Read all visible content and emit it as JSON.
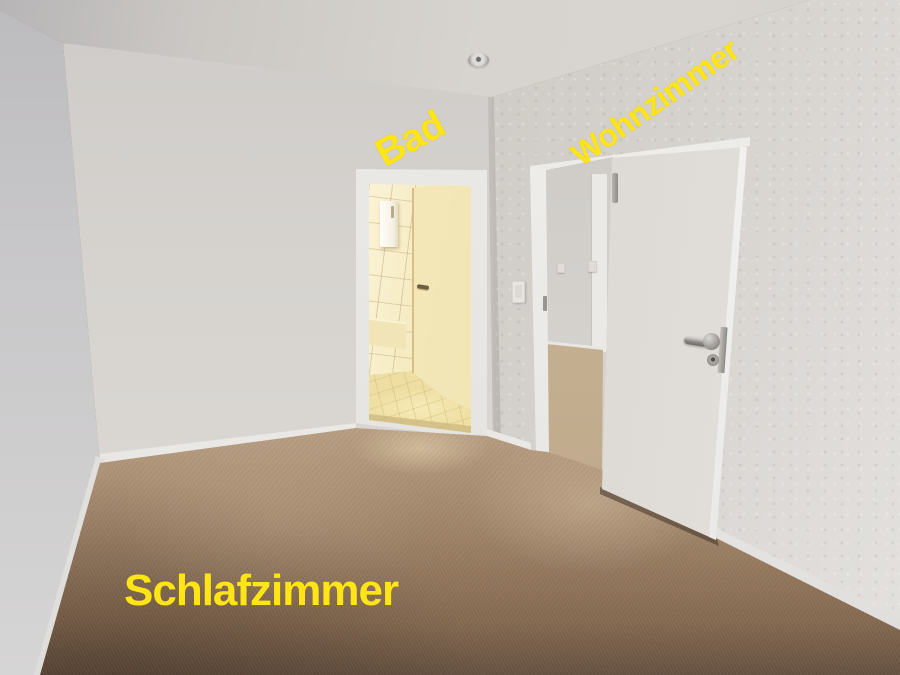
{
  "photo": {
    "description": "Empty bedroom with brown carpet; open doorway to a warmly lit bathroom and an open white door to the living room",
    "annotations": {
      "bathroom": "Bad",
      "living_room": "Wohnzimmer",
      "bedroom": "Schlafzimmer"
    },
    "annotation_color": "#ffe515",
    "colors": {
      "carpet_foreground": "#6b5442",
      "carpet_light": "#bca488",
      "wall_gray": "#d6d3cf",
      "ceiling_gray": "#d4d1cc",
      "door_white": "#e2dfda",
      "bathroom_warm_light": "#f5ecc3"
    }
  }
}
